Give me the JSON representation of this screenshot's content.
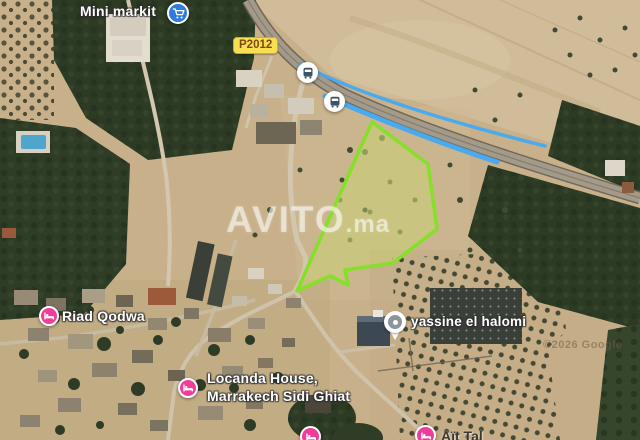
{
  "map": {
    "watermark": {
      "brand": "AVITO",
      "tld": ".ma"
    },
    "attribution": "©2026 Google",
    "road_shield": "P2012",
    "colors": {
      "plot_outline": "#86df28",
      "plot_fill": "rgba(200,215,110,0.45)",
      "route_blue": "#3fa9f5",
      "hotel_pin_pink": "#ef3d99",
      "shop_pin_blue": "#2e7ce0",
      "shield_yellow": "#f8df4f"
    },
    "pois": {
      "mini_markit": {
        "label": "Mini markit",
        "icon": "shopping-cart"
      },
      "bus_stop_north": {
        "icon": "bus"
      },
      "bus_stop_south": {
        "icon": "bus"
      },
      "riad_qodwa": {
        "label": "Riad Qodwa",
        "icon": "bed"
      },
      "yassine_el_halomi": {
        "label": "yassine el halomi",
        "icon": "generic-place"
      },
      "locanda_house": {
        "label_line1": "Locanda House,",
        "label_line2": "Marrakech Sidi Ghiat",
        "icon": "bed"
      },
      "bottom_pin_left": {
        "icon": "bed"
      },
      "bottom_pin_right": {
        "label": "Aït Tal",
        "icon": "bed"
      }
    }
  }
}
